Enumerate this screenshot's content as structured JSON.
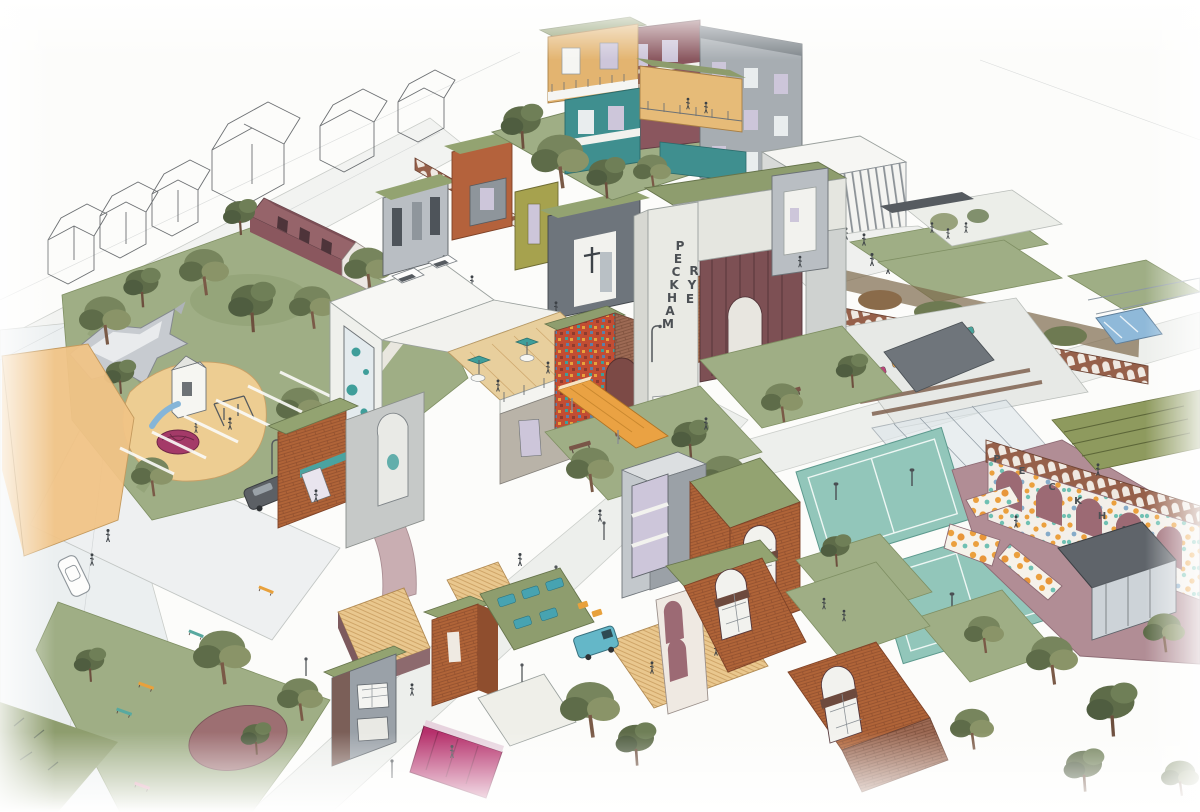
{
  "illustration": {
    "kind": "hand-drawn aerial masterplan illustration",
    "signage": {
      "portal": {
        "word1": "PECKHAM",
        "word1_letters": [
          "P",
          "E",
          "C",
          "K",
          "H",
          "A",
          "M"
        ],
        "word2": "RYE",
        "word2_letters": [
          "R",
          "Y",
          "E"
        ]
      },
      "arch_wall": {
        "word": "PECKHAM",
        "letters": [
          "P",
          "E",
          "C",
          "K",
          "H",
          "A",
          "M"
        ]
      }
    },
    "palette": {
      "paper": "#fcfcfa",
      "lawn_green": "#9fae85",
      "tree_green": "#6f7f57",
      "sand": "#edcd92",
      "timber_deck": "#e9c78e",
      "brick_orange": "#b06438",
      "brick_maroon": "#8d5660",
      "mauve_plaza": "#b18d95",
      "teal_court": "#92c6ba",
      "teal_accent": "#3f9e9a",
      "magenta": "#b5306b",
      "confetti_orange": "#eba03e",
      "gray_building": "#b9bec3",
      "window_lavender": "#cdc6da",
      "green_roof": "#93a371",
      "ink": "#3f4448"
    }
  }
}
